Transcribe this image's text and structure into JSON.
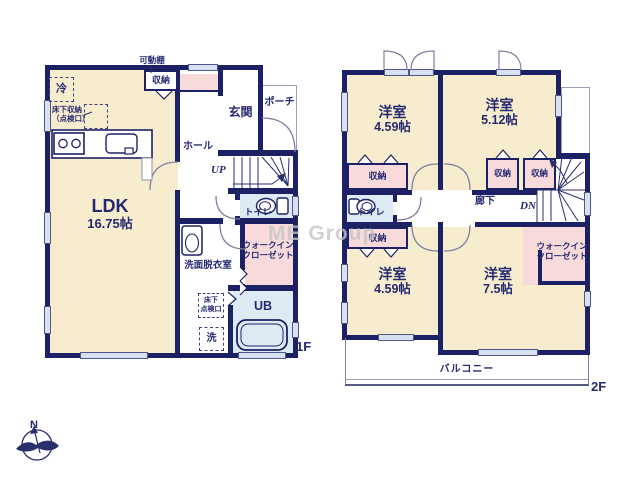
{
  "watermark": "ME Group",
  "compass": {
    "north": "N"
  },
  "floor1": {
    "label": "1F",
    "ldk": {
      "name": "LDK",
      "size": "16.75帖"
    },
    "kadodana": "可動棚",
    "shuno": "収納",
    "rei": "冷",
    "yukashita": {
      "line1": "床下収納",
      "line2": "（点検口）"
    },
    "genkan": "玄関",
    "porch": "ポーチ",
    "hall": "ホール",
    "up": "UP",
    "toilet": "トイレ",
    "wic": {
      "line1": "ウォークイン",
      "line2": "クローゼット"
    },
    "senmen": "洗面脱衣室",
    "tenken": {
      "line1": "床下",
      "line2": "点検口"
    },
    "washer": "洗",
    "ub": "UB"
  },
  "floor2": {
    "label": "2F",
    "rooms": [
      {
        "name": "洋室",
        "size": "4.59帖"
      },
      {
        "name": "洋室",
        "size": "5.12帖"
      },
      {
        "name": "洋室",
        "size": "4.59帖"
      },
      {
        "name": "洋室",
        "size": "7.5帖"
      }
    ],
    "shuno": "収納",
    "toilet": "トイレ",
    "rouka": "廊下",
    "dn": "DN",
    "wic": {
      "line1": "ウォークイン",
      "line2": "クローゼット"
    },
    "balcony": "バルコニー"
  }
}
